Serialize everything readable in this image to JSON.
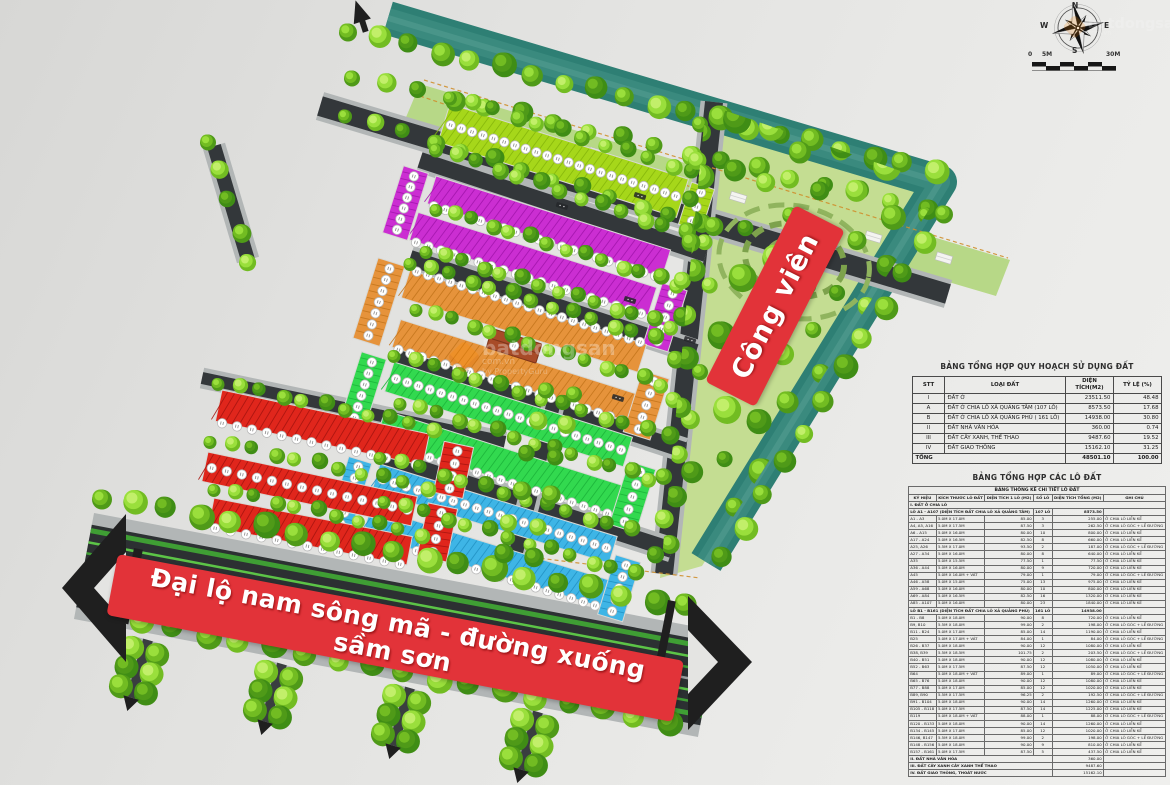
{
  "banners": {
    "boulevard": "Đại lộ nam sông mã - đường xuống sầm sơn",
    "park": "Công viên"
  },
  "compass": {
    "n": "N",
    "e": "E",
    "s": "S",
    "w": "W"
  },
  "scalebar": {
    "left": "0",
    "mid": "5M",
    "right": "30M"
  },
  "watermark": {
    "brand": "batdongsan",
    "domain": "com.vn",
    "byline": "by PropertyGuru"
  },
  "tables": {
    "plan_summary": {
      "title": "BẢNG TỔNG HỢP QUY HOẠCH SỬ DỤNG ĐẤT",
      "headers": [
        "STT",
        "LOẠI ĐẤT",
        "DIỆN TÍCH(M2)",
        "TỶ LỆ (%)"
      ],
      "rows": [
        [
          "I",
          "ĐẤT Ở",
          "23511.50",
          "48.48"
        ],
        [
          "A",
          "ĐẤT Ở CHIA LÔ XÃ QUẢNG TÂM (107 LÔ)",
          "8573.50",
          "17.68"
        ],
        [
          "B",
          "ĐẤT Ở CHIA LÔ XÃ QUẢNG PHÚ ( 161 LÔ)",
          "14938.00",
          "30.80"
        ],
        [
          "II",
          "ĐẤT NHÀ VĂN HÓA",
          "360.00",
          "0.74"
        ],
        [
          "III",
          "ĐẤT CÂY XANH, THỂ THAO",
          "9487.60",
          "19.52"
        ],
        [
          "IV",
          "ĐẤT GIAO THÔNG",
          "15162.10",
          "31.25"
        ]
      ],
      "total_row": [
        "TỔNG",
        "48501.10",
        "100.00"
      ]
    },
    "lots": {
      "title": "BẢNG TỔNG HỢP CÁC LÔ ĐẤT",
      "subtitle": "BẢNG THỐNG KÊ CHI TIẾT LÔ ĐẤT",
      "headers": [
        "KÝ HIỆU",
        "KÍCH THƯỚC LÔ ĐẤT",
        "DIỆN TÍCH 1 LÔ (M2)",
        "SỐ LÔ",
        "DIỆN TÍCH TỔNG (M2)",
        "GHI CHÚ"
      ],
      "groups": [
        {
          "label": "I. ĐẤT Ở CHIA LÔ"
        },
        {
          "label": "LÔ A1 - A107 (DIỆN TÍCH ĐẤT CHIA LÔ XÃ QUẢNG TÂM)",
          "so_lo": "107 LÔ",
          "tong": "8573.50",
          "rows": [
            [
              "A1 - A3",
              "5.0M X 17.0M",
              "85.00",
              "3",
              "255.00",
              "Ở CHIA LÔ LIỀN KỀ"
            ],
            [
              "A4, A5, A16",
              "5.0M X 17.5M",
              "87.50",
              "3",
              "262.50",
              "Ở CHIA LÔ GÓC + LỀ ĐƯỜNG"
            ],
            [
              "A6 - A15",
              "5.0M X 16.0M",
              "80.00",
              "10",
              "800.00",
              "Ở CHIA LÔ LIỀN KỀ"
            ],
            [
              "A17 - A24",
              "5.0M X 16.5M",
              "82.50",
              "8",
              "660.00",
              "Ở CHIA LÔ LIỀN KỀ"
            ],
            [
              "A25, A26",
              "5.5M X 17.0M",
              "93.50",
              "2",
              "187.00",
              "Ở CHIA LÔ GÓC + LỀ ĐƯỜNG"
            ],
            [
              "A27 - A34",
              "5.0M X 16.0M",
              "80.00",
              "8",
              "640.00",
              "Ở CHIA LÔ LIỀN KỀ"
            ],
            [
              "A35",
              "5.0M X 15.5M",
              "77.50",
              "1",
              "77.50",
              "Ở CHIA LÔ LIỀN KỀ"
            ],
            [
              "A36 - A44",
              "5.0M X 16.0M",
              "80.00",
              "9",
              "720.00",
              "Ở CHIA LÔ LIỀN KỀ"
            ],
            [
              "A45",
              "5.0M X 16.0M + VÁT",
              "79.00",
              "1",
              "79.00",
              "Ở CHIA LÔ GÓC + LỀ ĐƯỜNG"
            ],
            [
              "A46 - A58",
              "5.0M X 15.0M",
              "75.00",
              "13",
              "975.00",
              "Ở CHIA LÔ LIỀN KỀ"
            ],
            [
              "A59 - A68",
              "5.0M X 16.0M",
              "80.00",
              "10",
              "800.00",
              "Ở CHIA LÔ LIỀN KỀ"
            ],
            [
              "A69 - A84",
              "5.0M X 16.5M",
              "82.50",
              "16",
              "1320.00",
              "Ở CHIA LÔ LIỀN KỀ"
            ],
            [
              "A85 - A107",
              "5.0M X 16.0M",
              "80.00",
              "23",
              "1840.00",
              "Ở CHIA LÔ LIỀN KỀ"
            ]
          ]
        },
        {
          "label": "LÔ B1 - B161 (DIỆN TÍCH ĐẤT CHIA LÔ XÃ QUẢNG PHÚ)",
          "so_lo": "161 LÔ",
          "tong": "14938.00",
          "rows": [
            [
              "B1 - B8",
              "5.0M X 18.0M",
              "90.00",
              "8",
              "720.00",
              "Ở CHIA LÔ LIỀN KỀ"
            ],
            [
              "B9, B10",
              "5.5M X 18.0M",
              "99.00",
              "2",
              "198.00",
              "Ở CHIA LÔ GÓC + LỀ ĐƯỜNG"
            ],
            [
              "B11 - B24",
              "5.0M X 17.0M",
              "85.00",
              "14",
              "1190.00",
              "Ở CHIA LÔ LIỀN KỀ"
            ],
            [
              "B25",
              "5.0M X 17.0M + VÁT",
              "84.00",
              "1",
              "84.00",
              "Ở CHIA LÔ GÓC + LỀ ĐƯỜNG"
            ],
            [
              "B26 - B37",
              "5.0M X 18.0M",
              "90.00",
              "12",
              "1080.00",
              "Ở CHIA LÔ LIỀN KỀ"
            ],
            [
              "B38, B39",
              "5.5M X 18.5M",
              "101.75",
              "2",
              "203.50",
              "Ở CHIA LÔ GÓC + LỀ ĐƯỜNG"
            ],
            [
              "B40 - B51",
              "5.0M X 18.0M",
              "90.00",
              "12",
              "1080.00",
              "Ở CHIA LÔ LIỀN KỀ"
            ],
            [
              "B52 - B63",
              "5.0M X 17.5M",
              "87.50",
              "12",
              "1050.00",
              "Ở CHIA LÔ LIỀN KỀ"
            ],
            [
              "B64",
              "5.0M X 18.0M + VÁT",
              "89.00",
              "1",
              "89.00",
              "Ở CHIA LÔ GÓC + LỀ ĐƯỜNG"
            ],
            [
              "B65 - B76",
              "5.0M X 18.0M",
              "90.00",
              "12",
              "1080.00",
              "Ở CHIA LÔ LIỀN KỀ"
            ],
            [
              "B77 - B88",
              "5.0M X 17.0M",
              "85.00",
              "12",
              "1020.00",
              "Ở CHIA LÔ LIỀN KỀ"
            ],
            [
              "B89, B90",
              "5.5M X 17.5M",
              "96.25",
              "2",
              "192.50",
              "Ở CHIA LÔ GÓC + LỀ ĐƯỜNG"
            ],
            [
              "B91 - B104",
              "5.0M X 18.0M",
              "90.00",
              "14",
              "1260.00",
              "Ở CHIA LÔ LIỀN KỀ"
            ],
            [
              "B105 - B118",
              "5.0M X 17.5M",
              "87.50",
              "14",
              "1225.00",
              "Ở CHIA LÔ LIỀN KỀ"
            ],
            [
              "B119",
              "5.0M X 18.0M + VÁT",
              "88.00",
              "1",
              "88.00",
              "Ở CHIA LÔ GÓC + LỀ ĐƯỜNG"
            ],
            [
              "B120 - B133",
              "5.0M X 18.0M",
              "90.00",
              "14",
              "1260.00",
              "Ở CHIA LÔ LIỀN KỀ"
            ],
            [
              "B134 - B145",
              "5.0M X 17.0M",
              "85.00",
              "12",
              "1020.00",
              "Ở CHIA LÔ LIỀN KỀ"
            ],
            [
              "B146, B147",
              "5.5M X 18.0M",
              "99.00",
              "2",
              "198.00",
              "Ở CHIA LÔ GÓC + LỀ ĐƯỜNG"
            ],
            [
              "B148 - B156",
              "5.0M X 18.0M",
              "90.00",
              "9",
              "810.00",
              "Ở CHIA LÔ LIỀN KỀ"
            ],
            [
              "B157 - B161",
              "5.0M X 17.5M",
              "87.50",
              "5",
              "437.50",
              "Ở CHIA LÔ LIỀN KỀ"
            ]
          ]
        }
      ],
      "summary": [
        [
          "II. ĐẤT NHÀ VĂN HÓA",
          "360.00"
        ],
        [
          "III. ĐẤT CÂY XANH CÂY XANH THỂ THAO",
          "9487.60"
        ],
        [
          "IV. ĐẤT GIAO THÔNG, THOÁT NƯỚC",
          "15162.10"
        ]
      ]
    }
  },
  "colors": {
    "canal": "#2e7f74",
    "park_ground": "#c4dd92",
    "road_asphalt": "#33373a",
    "sidewalk": "#b2b6b6",
    "boulevard_asphalt": "#2c3032",
    "banner_red": "#e23339",
    "block_chartreuse": "#a6d71a",
    "block_magenta": "#cb2ed2",
    "block_orange": "#e6933b",
    "block_green": "#32d94f",
    "block_blue": "#3eb5e6",
    "block_red": "#e0261c",
    "tree_dark": "#4f9a18",
    "tree_mid": "#72bc22",
    "tree_light": "#9adf3c",
    "boundary_dash": "#cf8f2e"
  }
}
